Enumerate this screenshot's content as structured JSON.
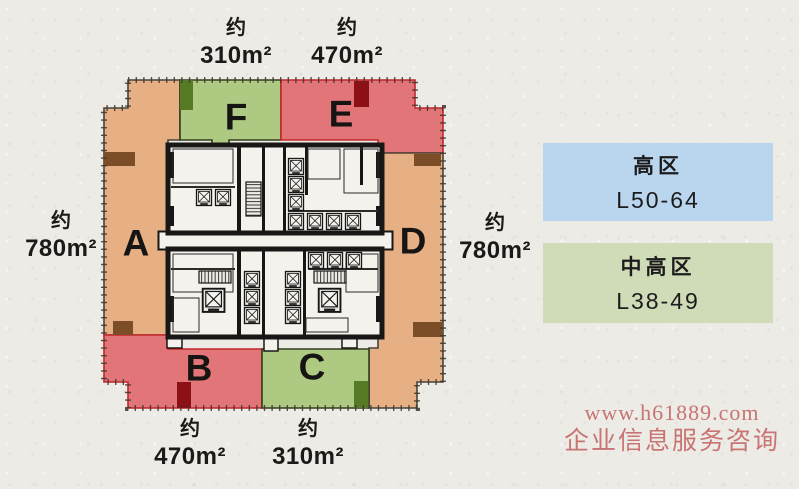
{
  "figure": {
    "background": "#edebe6",
    "zones": {
      "a": {
        "letter": "A",
        "fill": "#e6b084",
        "stroke": "#4a4238",
        "notch": "#7b4e28"
      },
      "b": {
        "letter": "B",
        "fill": "#e27577",
        "stroke": "#c5262a",
        "notch": "#8c1016"
      },
      "c": {
        "letter": "C",
        "fill": "#aeca82",
        "stroke": "#333f1e",
        "notch": "#567a26"
      },
      "d": {
        "letter": "D",
        "fill": "#e6b084",
        "stroke": "#4a4238",
        "notch": "#7b4e28"
      },
      "e": {
        "letter": "E",
        "fill": "#e27577",
        "stroke": "#c5262a",
        "notch": "#8c1016"
      },
      "f": {
        "letter": "F",
        "fill": "#aeca82",
        "stroke": "#333f1e",
        "notch": "#567a26"
      }
    },
    "area_labels": {
      "f": {
        "prefix": "约",
        "value": "310m²"
      },
      "e": {
        "prefix": "约",
        "value": "470m²"
      },
      "a": {
        "prefix": "约",
        "value": "780m²"
      },
      "d": {
        "prefix": "约",
        "value": "780m²"
      },
      "b": {
        "prefix": "约",
        "value": "470m²"
      },
      "c": {
        "prefix": "约",
        "value": "310m²"
      }
    }
  },
  "legend": {
    "items": [
      {
        "title": "高区",
        "floors": "L50-64",
        "color": "#bad5ee"
      },
      {
        "title": "中高区",
        "floors": "L38-49",
        "color": "#d0dbb8"
      }
    ]
  },
  "watermark": {
    "line1": "www.h61889.com",
    "line2": "企业信息服务咨询",
    "color": "#c56a6a"
  }
}
